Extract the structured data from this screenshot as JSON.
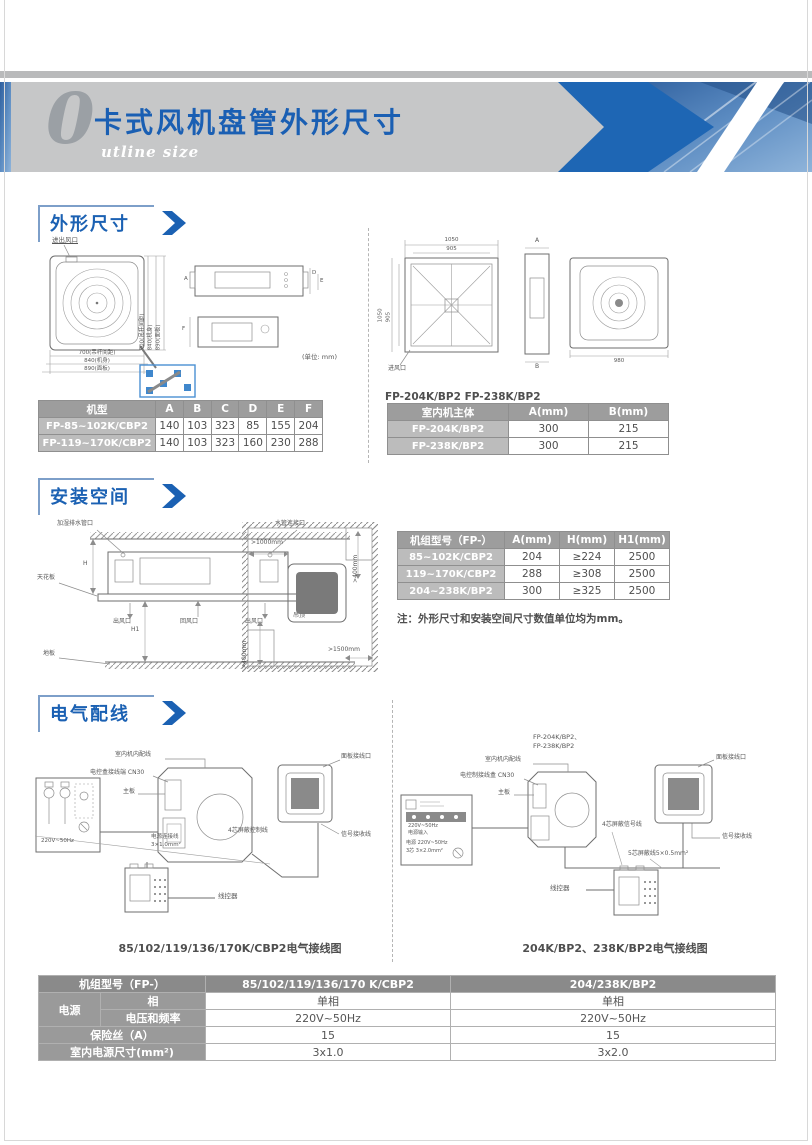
{
  "header": {
    "big_letter": "0",
    "title": "卡式风机盘管外形尺寸",
    "subtitle": "utline size"
  },
  "outline": {
    "title": "外形尺寸",
    "unit_note": "(单位: mm)",
    "left": {
      "inlet": "进出风口",
      "dims": [
        "700(吊杆间距)",
        "840(机身)",
        "890(面板)"
      ],
      "side_a": "A",
      "side_d": "D",
      "side_e": "E",
      "side_f": "F"
    },
    "right": {
      "caption": "FP-204K/BP2  FP-238K/BP2",
      "top_outer": "1050",
      "top_inner": "905",
      "left_outer": "1050",
      "left_inner": "905",
      "panel_w": "980",
      "a": "A",
      "b": "B",
      "inlet": "进风口"
    },
    "t1": {
      "h": [
        "机型",
        "A",
        "B",
        "C",
        "D",
        "E",
        "F"
      ],
      "r": [
        [
          "FP-85~102K/CBP2",
          "140",
          "103",
          "323",
          "85",
          "155",
          "204"
        ],
        [
          "FP-119~170K/CBP2",
          "140",
          "103",
          "323",
          "160",
          "230",
          "288"
        ]
      ]
    },
    "t2": {
      "h": [
        "室内机主体",
        "A(mm)",
        "B(mm)"
      ],
      "r": [
        [
          "FP-204K/BP2",
          "300",
          "215"
        ],
        [
          "FP-238K/BP2",
          "300",
          "215"
        ]
      ]
    }
  },
  "install": {
    "title": "安装空间",
    "side": {
      "drain": "加湿排水管口",
      "pipe": "水管连接口",
      "ceiling": "天花板",
      "outlet1": "出风口",
      "ret": "回风口",
      "outlet2": "出风口",
      "hanger": "吊顶",
      "floor": "地板",
      "h": "H",
      "h1": "H1"
    },
    "top": {
      "c_top": ">1000mm",
      "c_right": ">400mm",
      "c_left": ">400mm",
      "c_bottom": ">1500mm"
    },
    "t": {
      "h": [
        "机组型号（FP-）",
        "A(mm)",
        "H(mm)",
        "H1(mm)"
      ],
      "r": [
        [
          "85~102K/CBP2",
          "204",
          "≥224",
          "2500"
        ],
        [
          "119~170K/CBP2",
          "288",
          "≥308",
          "2500"
        ],
        [
          "204~238K/BP2",
          "300",
          "≥325",
          "2500"
        ]
      ]
    },
    "note": "注：外形尺寸和安装空间尺寸数值单位均为mm。"
  },
  "wiring": {
    "title": "电气配线",
    "left": {
      "internal": "室内机内配线",
      "cn30": "电控盒接线端 CN30",
      "board": "主板",
      "power": "220V~50Hz",
      "cable1": "电源连接线",
      "cable1b": "3×1.0mm²",
      "cable4": "4芯屏蔽控制线",
      "panel_port": "面板接线口",
      "signal": "信号接收线",
      "ctrl": "线控器",
      "caption": "85/102/119/136/170K/CBP2电气接线图"
    },
    "right": {
      "m1": "FP-204K/BP2、",
      "m2": "FP-238K/BP2",
      "internal": "室内机内配线",
      "cn30": "电控制接线盒 CN30",
      "board": "主板",
      "pb1": "220V~50Hz",
      "pb2": "电源输入",
      "pb3": "电源 220V~50Hz",
      "pb4": "3芯 3×2.0mm²",
      "cable4": "4芯屏蔽信号线",
      "cable5": "5芯屏蔽线5×0.5mm²",
      "panel_port": "面板接线口",
      "signal": "信号接收线",
      "ctrl": "线控器",
      "caption": "204K/BP2、238K/BP2电气接线图"
    }
  },
  "power_table": {
    "h": [
      "机组型号（FP-）",
      "85/102/119/136/170 K/CBP2",
      "204/238K/BP2"
    ],
    "group": "电源",
    "rows": [
      [
        "相",
        "单相",
        "单相"
      ],
      [
        "电压和频率",
        "220V~50Hz",
        "220V~50Hz"
      ],
      [
        "保险丝（A）",
        "15",
        "15"
      ],
      [
        "室内电源尺寸(mm²)",
        "3x1.0",
        "3x2.0"
      ]
    ]
  }
}
